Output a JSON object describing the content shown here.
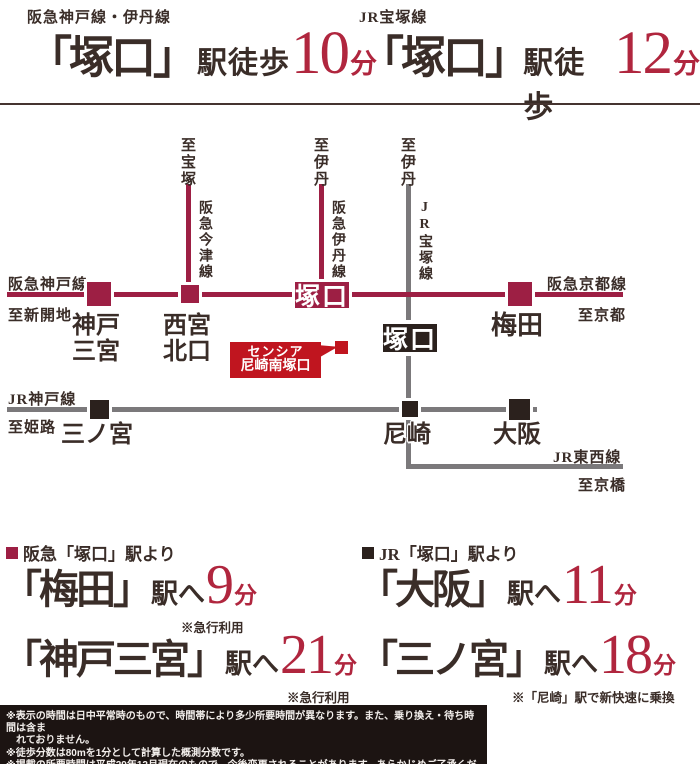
{
  "header": {
    "left": {
      "line_label": "阪急神戸線・伊丹線",
      "station": "「塚口」",
      "walk_label": "駅徒歩",
      "minutes": "10",
      "unit": "分"
    },
    "right": {
      "line_label": "JR宝塚線",
      "station": "「塚口」",
      "walk_label": "駅徒歩",
      "minutes": "12",
      "unit": "分"
    }
  },
  "map": {
    "hankyu_kobe_line": "阪急神戸線",
    "to_shinkaichi": "至新開地",
    "hankyu_kyoto_line": "阪急京都線",
    "to_kyoto": "至京都",
    "jr_kobe_line": "JR神戸線",
    "to_himeji": "至姫路",
    "jr_tozai_line": "JR東西線",
    "to_kyobashi": "至京橋",
    "hankyu_imazu_line": "阪急今津線",
    "to_takarazuka": "至宝塚",
    "hankyu_itami_line": "阪急伊丹線",
    "to_itami_hankyu": "至伊丹",
    "jr_takarazuka_line": "JR宝塚線",
    "to_itami_jr": "至伊丹",
    "stations": {
      "kobe_sannomiya_1": "神戸",
      "kobe_sannomiya_2": "三宮",
      "nishinomiya_1": "西宮",
      "nishinomiya_2": "北口",
      "tsukaguchi_hankyu": "塚口",
      "tsukaguchi_jr": "塚口",
      "umeda": "梅田",
      "sannomiya": "三ノ宮",
      "amagasaki": "尼崎",
      "osaka": "大阪"
    },
    "property": {
      "line1": "センシア",
      "line2": "尼崎南塚口"
    }
  },
  "access": {
    "left": {
      "heading": "阪急「塚口」駅より",
      "rows": [
        {
          "station": "「梅田」",
          "to": "駅へ",
          "minutes": "9",
          "unit": "分",
          "note": "※急行利用"
        },
        {
          "station": "「神戸三宮」",
          "to": "駅へ",
          "minutes": "21",
          "unit": "分",
          "note": "※急行利用"
        }
      ]
    },
    "right": {
      "heading": "JR「塚口」駅より",
      "rows": [
        {
          "station": "「大阪」",
          "to": "駅へ",
          "minutes": "11",
          "unit": "分",
          "note": ""
        },
        {
          "station": "「三ノ宮」",
          "to": "駅へ",
          "minutes": "18",
          "unit": "分",
          "note": "※「尼崎」駅で新快速に乗換"
        }
      ]
    }
  },
  "footer": {
    "lines": [
      "※表示の時間は日中平常時のもので、時間帯により多少所要時間が異なります。また、乗り換え・待ち時間は含ま",
      "れておりません。",
      "※徒歩分数は80mを1分として計算した概測分数です。",
      "※掲載の所要時間は平成29年12月現在のもので、今後変更されることがあります。あらかじめご了承ください。"
    ]
  },
  "colors": {
    "crimson": "#9d1f44",
    "red_accent": "#b0263e",
    "jr_gray": "#7b797b",
    "dark": "#2b211d",
    "property_red": "#c0151f",
    "text_dark": "#3a2d28"
  }
}
